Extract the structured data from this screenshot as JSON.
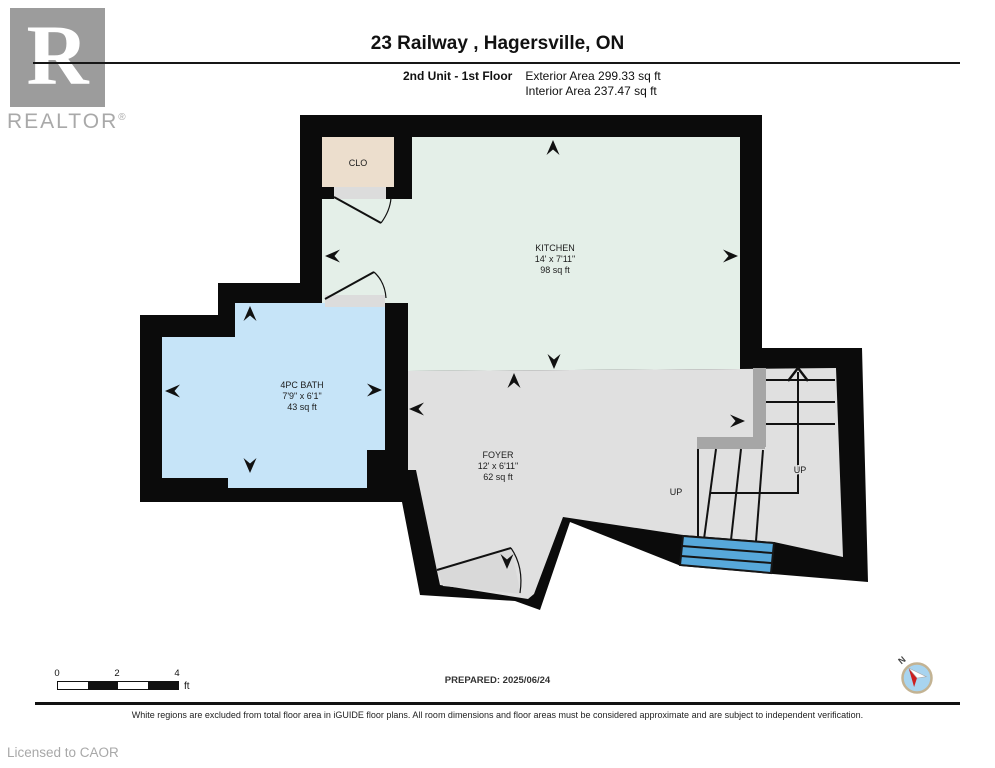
{
  "header": {
    "logo": {
      "letter": "R",
      "brand": "REALTOR",
      "reg": "®"
    },
    "title": "23 Railway , Hagersville, ON",
    "floor_label": "2nd Unit - 1st Floor",
    "exterior_area": "Exterior Area 299.33 sq ft",
    "interior_area": "Interior Area 237.47 sq ft"
  },
  "plan": {
    "rooms": [
      {
        "name": "KITCHEN",
        "dims": "14' x 7'11\"",
        "area": "98 sq ft",
        "color": "#e4efe8"
      },
      {
        "name": "4PC BATH",
        "dims": "7'9\" x 6'1\"",
        "area": "43 sq ft",
        "color": "#c6e4f8"
      },
      {
        "name": "FOYER",
        "dims": "12' x 6'11\"",
        "area": "62 sq ft",
        "color": "#e0e0e0"
      },
      {
        "name": "CLO",
        "dims": "",
        "area": "",
        "color": "#ecdecd"
      }
    ],
    "stair_up_label": "UP",
    "entry_up_label": "UP",
    "wall_color": "#0b0b0b",
    "steps_color": "#57a8da",
    "halfwall_color": "#a6a6a6",
    "threshold_color": "#dcdcdc"
  },
  "footer": {
    "scale_ticks": [
      "0",
      "2",
      "4"
    ],
    "scale_unit": "ft",
    "prepared": "PREPARED: 2025/06/24",
    "compass_label": "N",
    "disclaimer": "White regions are excluded from total floor area in iGUIDE floor plans. All room dimensions and floor areas must be considered approximate and are subject to independent verification.",
    "license": "Licensed to CAOR"
  }
}
